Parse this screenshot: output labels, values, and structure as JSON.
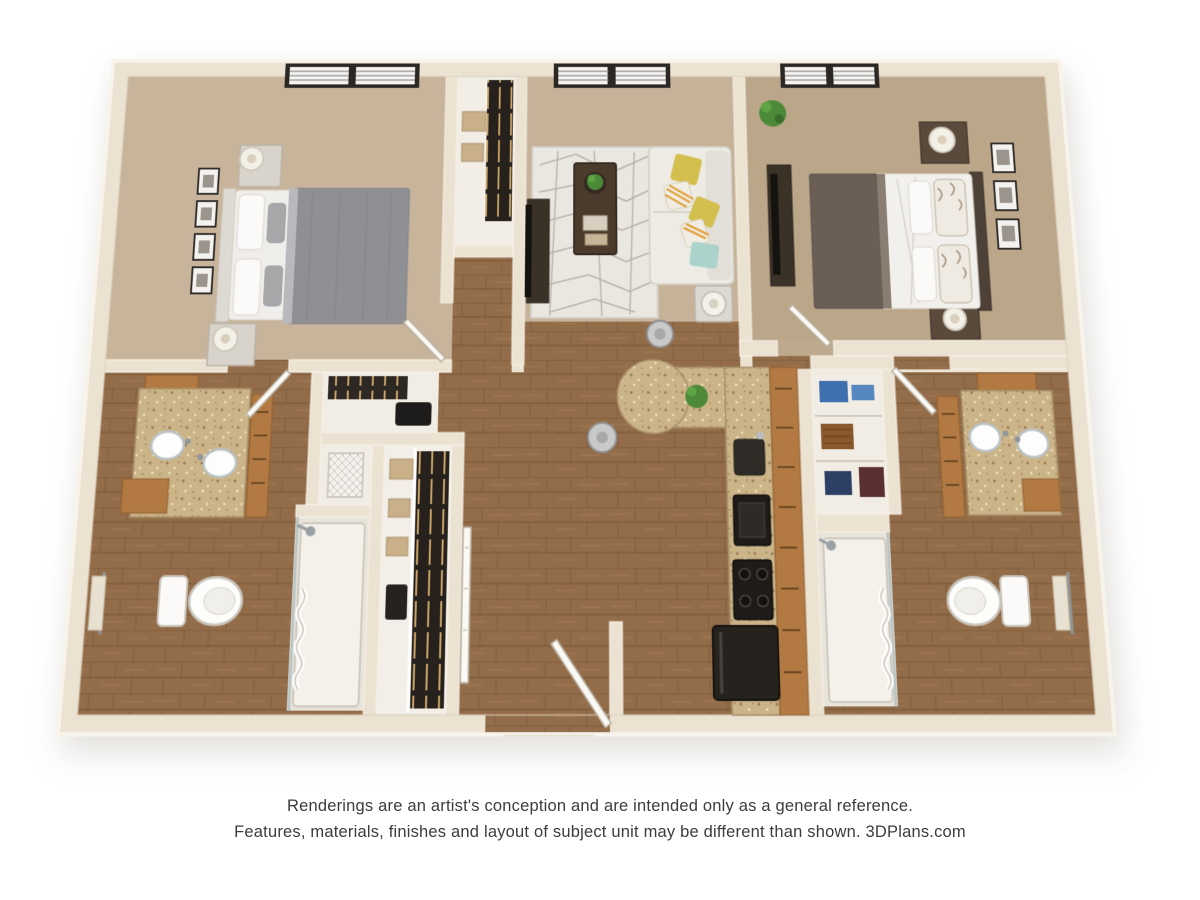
{
  "page": {
    "background": "#ffffff"
  },
  "disclaimer": {
    "line1": "Renderings are an artist's conception and are intended only as a general reference.",
    "line2": "Features, materials, finishes and layout of subject unit may be different than shown. 3DPlans.com"
  },
  "floorplan": {
    "type": "3d-floor-plan",
    "view": "top-down perspective rendering",
    "unit": {
      "bedrooms": 2,
      "bathrooms": 2
    },
    "rooms": [
      {
        "id": "bedroom-1",
        "label": "Bedroom 1",
        "floor": "carpet",
        "furniture": [
          "queen bed with gray duvet",
          "white headboard",
          "2 nightstands",
          "2 table lamps",
          "4 framed pictures",
          "window with blinds"
        ]
      },
      {
        "id": "living-room",
        "label": "Living Room",
        "floor": "carpet",
        "furniture": [
          "white sectional sofa",
          "yellow and teal accent pillows",
          "geometric area rug",
          "dark wood coffee table with plant and books",
          "tv console with tv",
          "side table with lamp",
          "window with blinds"
        ]
      },
      {
        "id": "bedroom-2",
        "label": "Bedroom 2",
        "floor": "carpet",
        "furniture": [
          "bed with brown duvet and white sheets",
          "dark headboard",
          "2 nightstands",
          "2 table lamps",
          "3 framed pictures",
          "media dresser",
          "potted plant",
          "window with blinds"
        ]
      },
      {
        "id": "bathroom-1",
        "label": "Bathroom 1",
        "floor": "hardwood",
        "furniture": [
          "double vanity with granite counter",
          "2 oval sinks",
          "wood cabinets",
          "toilet",
          "towel bar with towel",
          "shower with curtain"
        ]
      },
      {
        "id": "bathroom-2",
        "label": "Bathroom 2",
        "floor": "hardwood",
        "furniture": [
          "double vanity with granite counter",
          "2 oval sinks",
          "wood cabinets",
          "toilet",
          "towel bar with towel",
          "shower with curtain"
        ]
      },
      {
        "id": "kitchen",
        "label": "Kitchen",
        "floor": "hardwood",
        "furniture": [
          "L-shaped granite counter",
          "rounded breakfast-bar peninsula",
          "2 metal bar stools",
          "sink",
          "wall oven",
          "range with burners",
          "refrigerator",
          "wood cabinet run",
          "potted plant"
        ]
      },
      {
        "id": "hall-dining",
        "label": "Hall / Dining Area",
        "floor": "hardwood",
        "furniture": []
      },
      {
        "id": "walk-in-closet",
        "label": "Walk-in Closet",
        "floor": "light",
        "furniture": [
          "shelving with storage boxes",
          "hanging clothes"
        ]
      },
      {
        "id": "reach-in-closet",
        "label": "Closet",
        "floor": "light",
        "furniture": [
          "shelf with boxes",
          "hanging clothes"
        ]
      },
      {
        "id": "coat-closet",
        "label": "Coat Closet",
        "floor": "light",
        "furniture": [
          "hanging clothes",
          "storage"
        ]
      },
      {
        "id": "linen-closet",
        "label": "Linen Closet",
        "floor": "light",
        "furniture": [
          "laundry hamper"
        ]
      },
      {
        "id": "laundry-closet",
        "label": "Laundry / Linen Closet",
        "floor": "light",
        "furniture": [
          "shelving with bins and towels"
        ]
      },
      {
        "id": "entry",
        "label": "Entry",
        "floor": "hardwood",
        "furniture": [
          "open entry door"
        ]
      }
    ],
    "colors": {
      "wall": "#ece2d2",
      "wall_edge": "#f8f4ec",
      "wall_shadow": "#d8ccb8",
      "carpet_bed1": "#c8b49a",
      "carpet_living": "#c6b299",
      "carpet_bed2": "#bfa98e",
      "wood_base": "#936c49",
      "wood_line": "#70502f",
      "granite_base": "#ccb489",
      "cabinet_wood": "#b27a42",
      "sofa_white": "#edebe4",
      "pillow_yellow": "#d2bf4e",
      "pillow_teal": "#abd3cc",
      "duvet_gray": "#8f9094",
      "duvet_brown": "#6b5f55",
      "rug_base": "#eae6e0",
      "dark_furniture": "#3a3127",
      "appliance_black": "#1e1b18",
      "plant_green": "#4c8a39",
      "window_frame": "#2a2724",
      "text": "#3c3c3c"
    }
  }
}
